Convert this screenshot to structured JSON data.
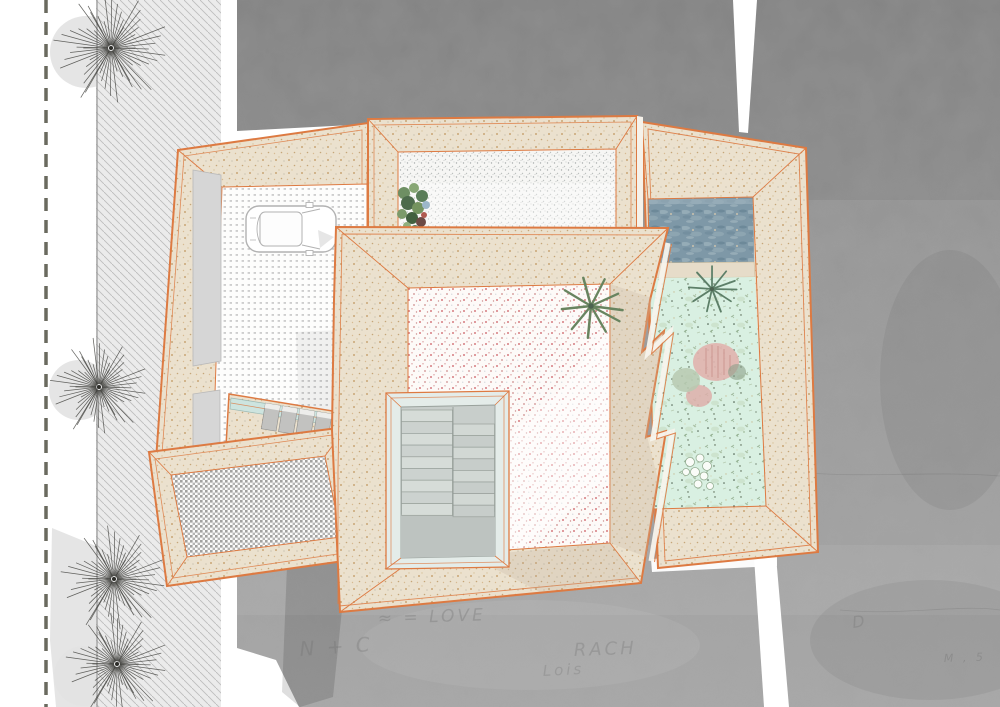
{
  "palette": {
    "outline": "#dd7a42",
    "wall": "#ebe1ce",
    "wall_dot": "#bf975f",
    "concrete_mid": "#9a9a9a",
    "hatch_bg": "#ebebeb",
    "hatch_line": "#bdbdbd",
    "dash_line": "#6a6a5f",
    "tree": "#3c3c38",
    "pool": "#7e98a7",
    "garden": "#d9f0e2",
    "floor_pink_dot": "#d06a70",
    "floor_grid_dot": "#c3c3c3",
    "stair_glass": "#e4ece9",
    "stair_well": "#c8cecb",
    "door_panel": "#d6d6d6",
    "seam_white": "#ffffff"
  },
  "site": {
    "trees": [
      {
        "x": 111,
        "y": 48,
        "r": 54
      },
      {
        "x": 99,
        "y": 387,
        "r": 46
      },
      {
        "x": 114,
        "y": 579,
        "r": 50
      },
      {
        "x": 117,
        "y": 664,
        "r": 48
      }
    ],
    "graffiti": [
      {
        "text": "≈ = LOVE",
        "x": 378,
        "y": 624,
        "size": 17,
        "rot": -2,
        "op": 0.33
      },
      {
        "text": "N + C",
        "x": 300,
        "y": 656,
        "size": 20,
        "rot": -4,
        "op": 0.3
      },
      {
        "text": "RACH",
        "x": 574,
        "y": 656,
        "size": 18,
        "rot": -2,
        "op": 0.3
      },
      {
        "text": "Lois",
        "x": 543,
        "y": 676,
        "size": 15,
        "rot": -3,
        "op": 0.28
      },
      {
        "text": "D",
        "x": 853,
        "y": 628,
        "size": 16,
        "rot": -8,
        "op": 0.3
      },
      {
        "text": "M , 5",
        "x": 944,
        "y": 662,
        "size": 11,
        "rot": -2,
        "op": 0.35
      }
    ]
  },
  "plan": {
    "stairwell": {
      "left_treads": 9,
      "right_treads": 8
    },
    "areas": {
      "street": "concrete-street",
      "sidewalk": "hatched-sidewalk",
      "garage": "carport-court",
      "top_court": "stipple-courtyard",
      "pool": "swimming-pool",
      "garden": "courtyard-garden",
      "main_court": "main-courtyard",
      "terrace": "lower-terrace",
      "stairwell": "stairwell"
    }
  }
}
